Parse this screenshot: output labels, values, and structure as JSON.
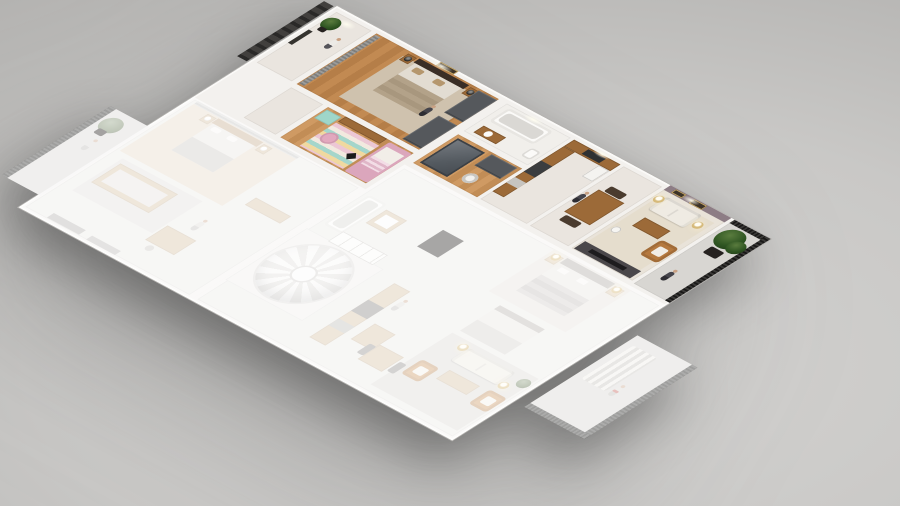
{
  "canvas": {
    "width": 900,
    "height": 506
  },
  "scene": {
    "type": "isometric-3d-floor-plan-render",
    "background_style": "plain gray studio gradient",
    "units": [
      {
        "id": "highlighted-apartment",
        "state": "full-color",
        "rooms": [
          "entry",
          "master-bedroom",
          "kids-room",
          "bathroom",
          "dressing-room",
          "kitchen",
          "dining",
          "living-room",
          "balcony"
        ],
        "furniture": [
          "double-bed-dark-headboard",
          "nightstands-with-black-lamps",
          "wardrobes",
          "kids-pink-bed",
          "mint-dresser",
          "striped-rug",
          "bathtub",
          "shower-cabin",
          "kitchen-counter",
          "fridge",
          "dining-table",
          "white-sofa",
          "coffee-bench",
          "tan-armchair",
          "gold-floor-lamps",
          "media-wall",
          "wall-art"
        ]
      },
      {
        "id": "faded-apartment-left",
        "state": "faded",
        "rooms": [
          "bedroom",
          "lounge",
          "balcony"
        ],
        "furniture": [
          "gray-bed",
          "wood-sofa",
          "desk",
          "cabinet"
        ]
      },
      {
        "id": "faded-apartment-center",
        "state": "faded",
        "rooms": [
          "bathroom",
          "spiral-staircase",
          "kitchen"
        ],
        "furniture": [
          "bathtub",
          "vanity",
          "spiral-stair",
          "kitchen-counter",
          "island"
        ]
      },
      {
        "id": "faded-apartment-right",
        "state": "faded",
        "rooms": [
          "bedroom-1",
          "bedroom-2",
          "living-room",
          "dining",
          "balcony"
        ],
        "furniture": [
          "bed-1",
          "bed-2",
          "white-sofa",
          "tan-armchairs",
          "coffee-table",
          "gold-floor-lamps",
          "dining-table",
          "striped-lounger"
        ]
      }
    ],
    "figures": [
      {
        "id": "entry-person",
        "style": "white-shirt-dark-pants"
      },
      {
        "id": "master-bedroom-person",
        "style": "dark"
      },
      {
        "id": "dining-person",
        "style": "dark"
      },
      {
        "id": "balcony-person",
        "style": "dark-suit"
      },
      {
        "id": "left-balcony-person",
        "style": "faded"
      },
      {
        "id": "center-person",
        "style": "faded"
      },
      {
        "id": "right-balcony-person",
        "style": "faded-white-red"
      }
    ],
    "plants": [
      "entry-plant",
      "right-balcony-large-plant",
      "left-balcony-plant-faded",
      "living-plant-faded"
    ]
  },
  "palette": {
    "wall": "#f3f1ee",
    "tile": "#eae5df",
    "bath_tile": "#f1efeb",
    "wood": "#c28a52",
    "wood_dark": "#9c6a38",
    "wardrobe": "#55585c",
    "door_dark": "#35332f",
    "bed_headboard": "#3a2e26",
    "bedding": "#e2dcd2",
    "pillow": "#b5976e",
    "kids_pink": "#e2a8be",
    "kids_mint": "#9fd6c9",
    "mauve_wall": "#8d7d85",
    "sofa_white": "#efebe3",
    "armchair_tan": "#b5793f",
    "lamp_gold": "#d6ba7a",
    "lamp_black": "#2b2a28",
    "media_dark": "#4a474a",
    "balcony_tile": "#d8d6d2",
    "railing": "#2c2b29",
    "plant": "#2f5522",
    "plant_pot": "#262220",
    "ghost_wood": "#d9c5aa",
    "ghost_floor": "#edebe8",
    "ghost_overlay": "rgba(255,255,255,0.58)",
    "skin": "#c9a183"
  }
}
